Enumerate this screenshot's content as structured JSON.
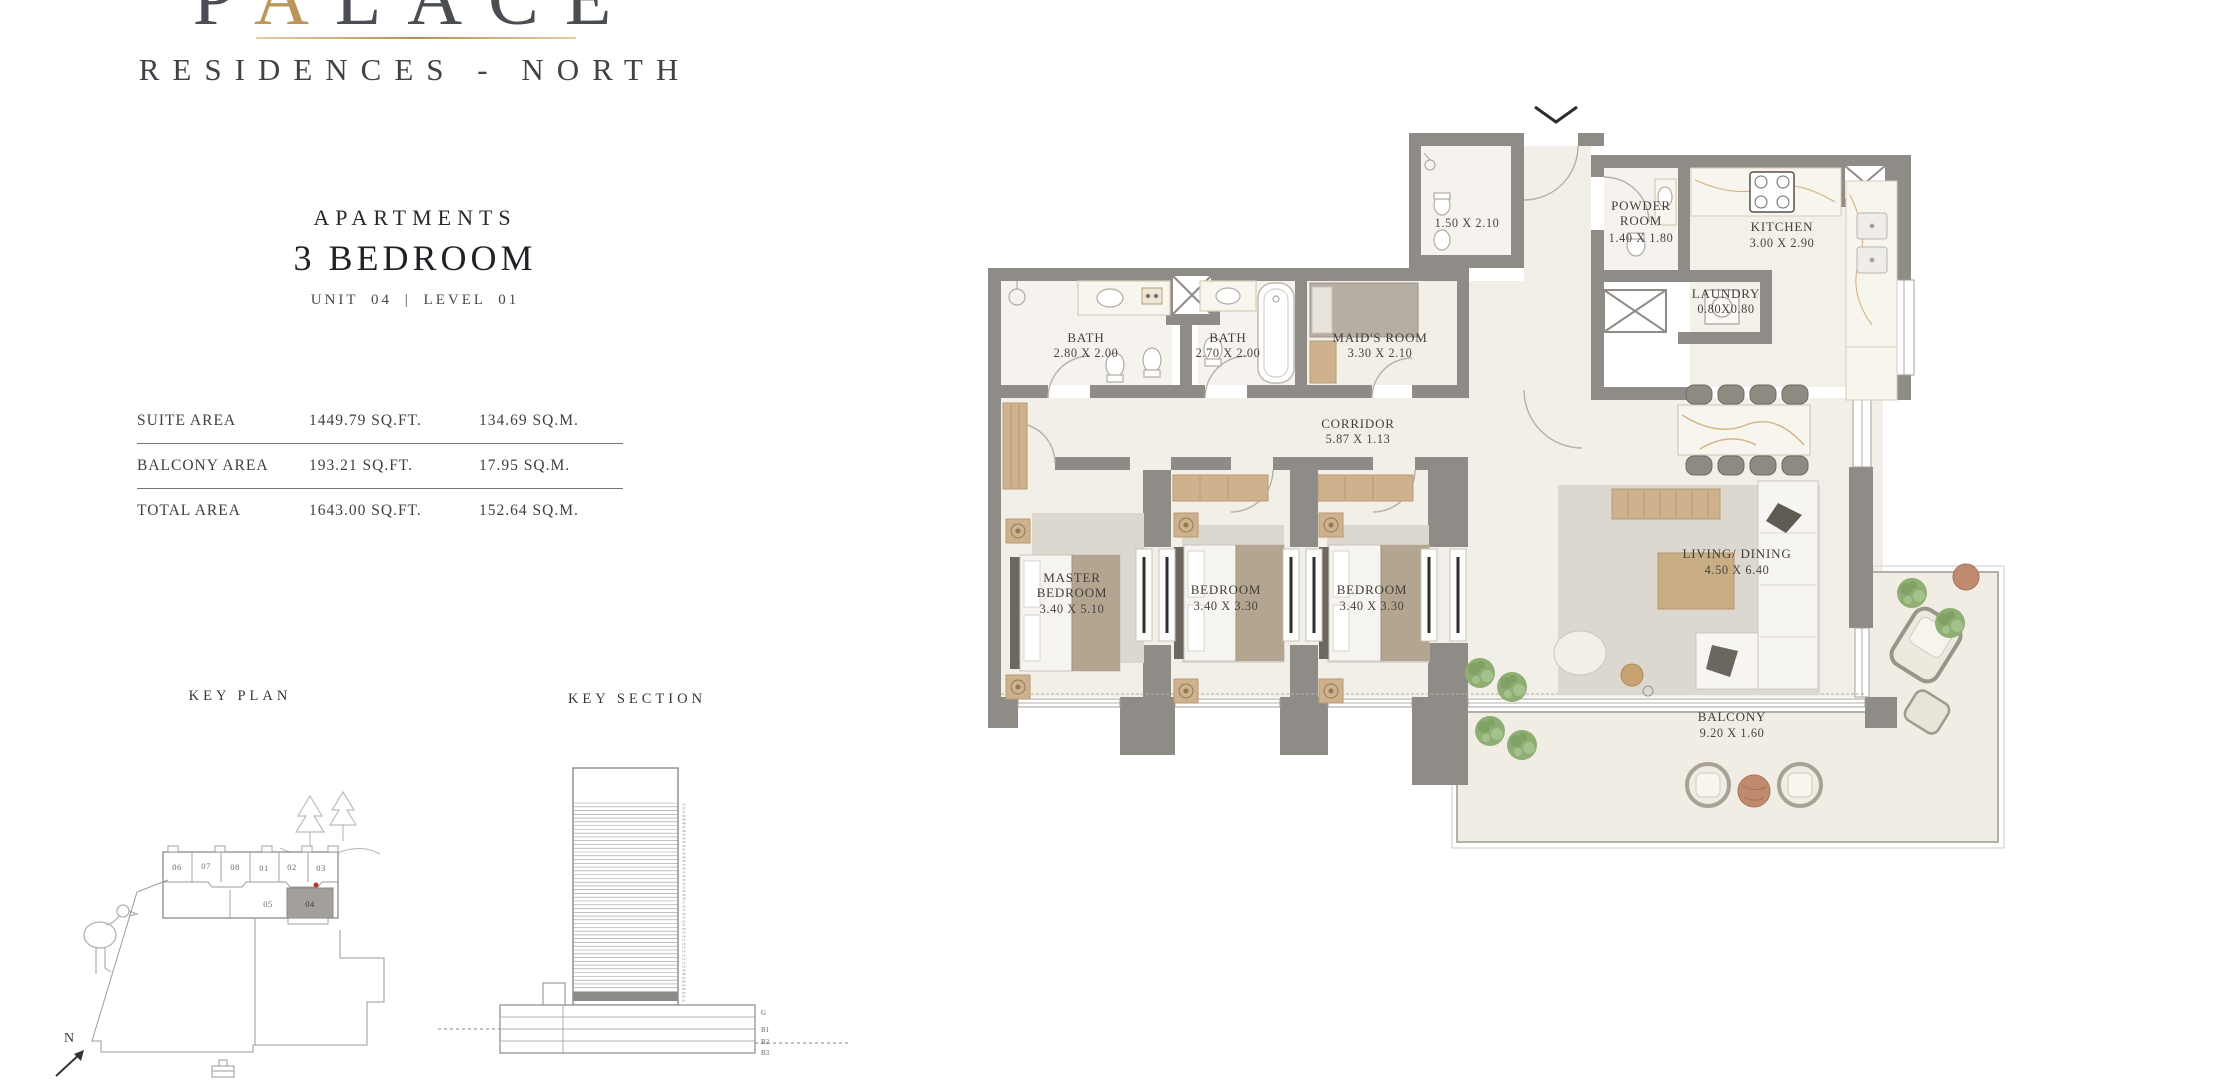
{
  "logo": {
    "prefix": "P",
    "gold_letter": "A",
    "suffix": "LACE",
    "tagline": "RESIDENCES - NORTH"
  },
  "unit_header": {
    "kicker": "APARTMENTS",
    "type": "3 BEDROOM",
    "unit_line": "UNIT 04   |   LEVEL 01"
  },
  "area_table": {
    "rows": [
      {
        "label": "SUITE AREA",
        "sqft": "1449.79 SQ.FT.",
        "sqm": "134.69 SQ.M."
      },
      {
        "label": "BALCONY AREA",
        "sqft": "193.21 SQ.FT.",
        "sqm": "17.95 SQ.M."
      },
      {
        "label": "TOTAL AREA",
        "sqft": "1643.00 SQ.FT.",
        "sqm": "152.64 SQ.M."
      }
    ]
  },
  "key_plan": {
    "title": "KEY PLAN",
    "units_top": [
      "06",
      "07",
      "08",
      "01",
      "02",
      "03"
    ],
    "units_bottom": [
      "05",
      "04"
    ],
    "highlighted_unit": "04",
    "north_label": "N"
  },
  "key_section": {
    "title": "KEY SECTION",
    "floors_top_to_bottom": [
      "53",
      "52",
      "51",
      "50",
      "49",
      "48",
      "47",
      "46",
      "45",
      "44",
      "43",
      "42",
      "41",
      "40",
      "39",
      "38",
      "37",
      "36",
      "35",
      "34",
      "33",
      "32",
      "31",
      "30",
      "29",
      "28",
      "27",
      "26",
      "25",
      "24",
      "23",
      "22",
      "21",
      "20",
      "19",
      "18",
      "17",
      "16",
      "15",
      "14",
      "13",
      "12",
      "11",
      "10",
      "09",
      "08",
      "07",
      "06",
      "05",
      "04",
      "03",
      "02",
      "01"
    ],
    "base_labels": [
      "G",
      "B1",
      "B2",
      "B3"
    ],
    "highlighted_floor": "01"
  },
  "floor_plan": {
    "rooms": {
      "bath_top": {
        "dims": "1.50 X 2.10"
      },
      "powder": {
        "line1": "POWDER",
        "line2": "ROOM",
        "dims": "1.40 X 1.80"
      },
      "kitchen": {
        "line1": "KITCHEN",
        "dims": "3.00 X 2.90"
      },
      "laundry": {
        "line1": "LAUNDRY",
        "dims": "0.80X0.80"
      },
      "bath1": {
        "line1": "BATH",
        "dims": "2.80 X 2.00"
      },
      "bath2": {
        "line1": "BATH",
        "dims": "2.70 X 2.00"
      },
      "maids": {
        "line1": "MAID'S ROOM",
        "dims": "3.30 X 2.10"
      },
      "corridor": {
        "line1": "CORRIDOR",
        "dims": "5.87 X 1.13"
      },
      "master": {
        "line1": "MASTER",
        "line2": "BEDROOM",
        "dims": "3.40 X 5.10"
      },
      "bedroom2": {
        "line1": "BEDROOM",
        "dims": "3.40 X 3.30"
      },
      "bedroom3": {
        "line1": "BEDROOM",
        "dims": "3.40 X 3.30"
      },
      "living": {
        "line1": "LIVING/ DINING",
        "dims": "4.50 X 6.40"
      },
      "balcony": {
        "line1": "BALCONY",
        "dims": "9.20 X 1.60"
      }
    }
  },
  "colors": {
    "wall": "#8f8c87",
    "floor": "#f2efe8",
    "bath_floor": "#f6f3ee",
    "balcony_floor": "#f1ede4",
    "wood": "#cdb28d",
    "marble_vein": "#d3b488",
    "gold": "#bb9659",
    "text": "#33373b",
    "plant": "#8fae74",
    "rug": "#dcd8d0"
  }
}
